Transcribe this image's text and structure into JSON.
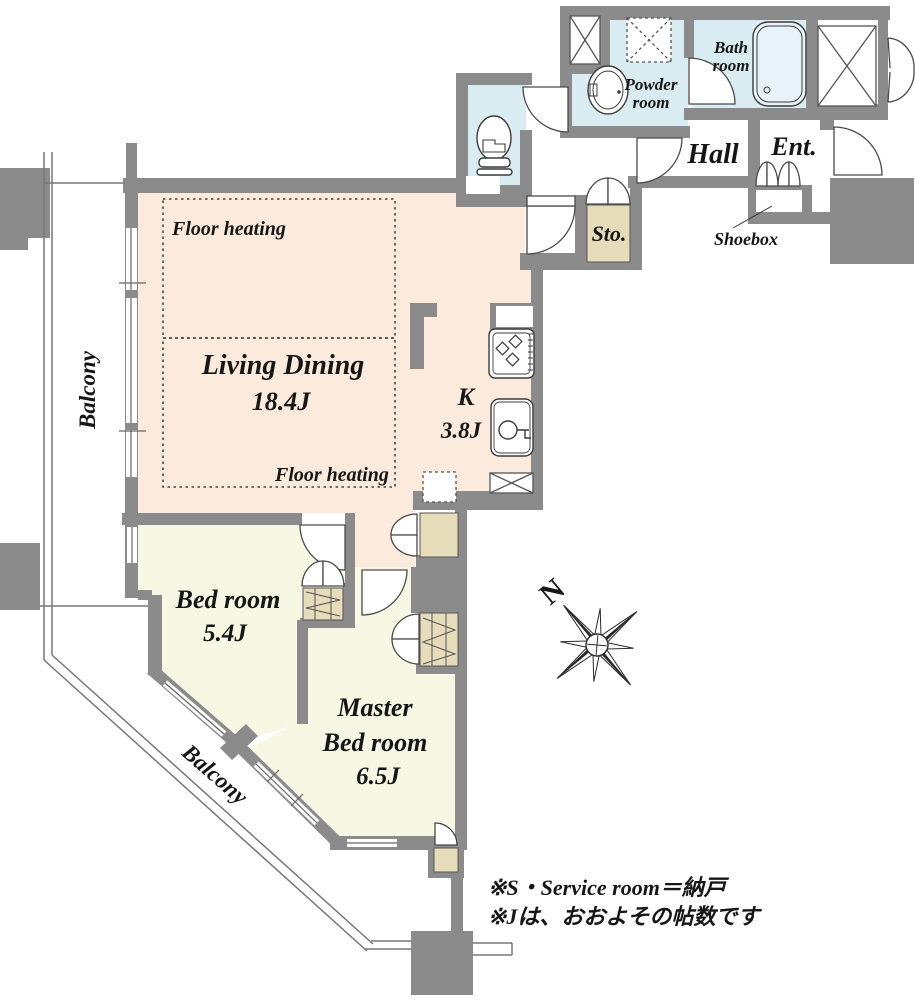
{
  "title": "Apartment floor plan 1LDK+S",
  "colors": {
    "wall": "#8b8b8b",
    "living": "#fcebdc",
    "bedroom": "#f7f8e3",
    "water": "#d9ecf2",
    "storage": "#e6dcba",
    "outline": "#4a4a4a",
    "text": "#161616"
  },
  "rooms": {
    "living": {
      "name": "Living Dining",
      "area": "18.4J"
    },
    "kitchen": {
      "name": "K",
      "area": "3.8J"
    },
    "bedroom": {
      "name": "Bed room",
      "area": "5.4J"
    },
    "master": {
      "name_line1": "Master",
      "name_line2": "Bed room",
      "area": "6.5J"
    },
    "bath": {
      "name_line1": "Bath",
      "name_line2": "room"
    },
    "powder": {
      "name_line1": "Powder",
      "name_line2": "room"
    },
    "hall": {
      "name": "Hall"
    },
    "entrance": {
      "name": "Ent."
    },
    "storage": {
      "name": "Sto."
    },
    "shoebox": {
      "name": "Shoebox"
    }
  },
  "annotations": {
    "floor_heating_top": "Floor heating",
    "floor_heating_bottom": "Floor heating",
    "balcony_left": "Balcony",
    "balcony_diagonal": "Balcony",
    "compass_north": "N"
  },
  "notes": {
    "line1": "※S・Service room＝納戸",
    "line2": "※Jは、おおよその帖数です"
  }
}
